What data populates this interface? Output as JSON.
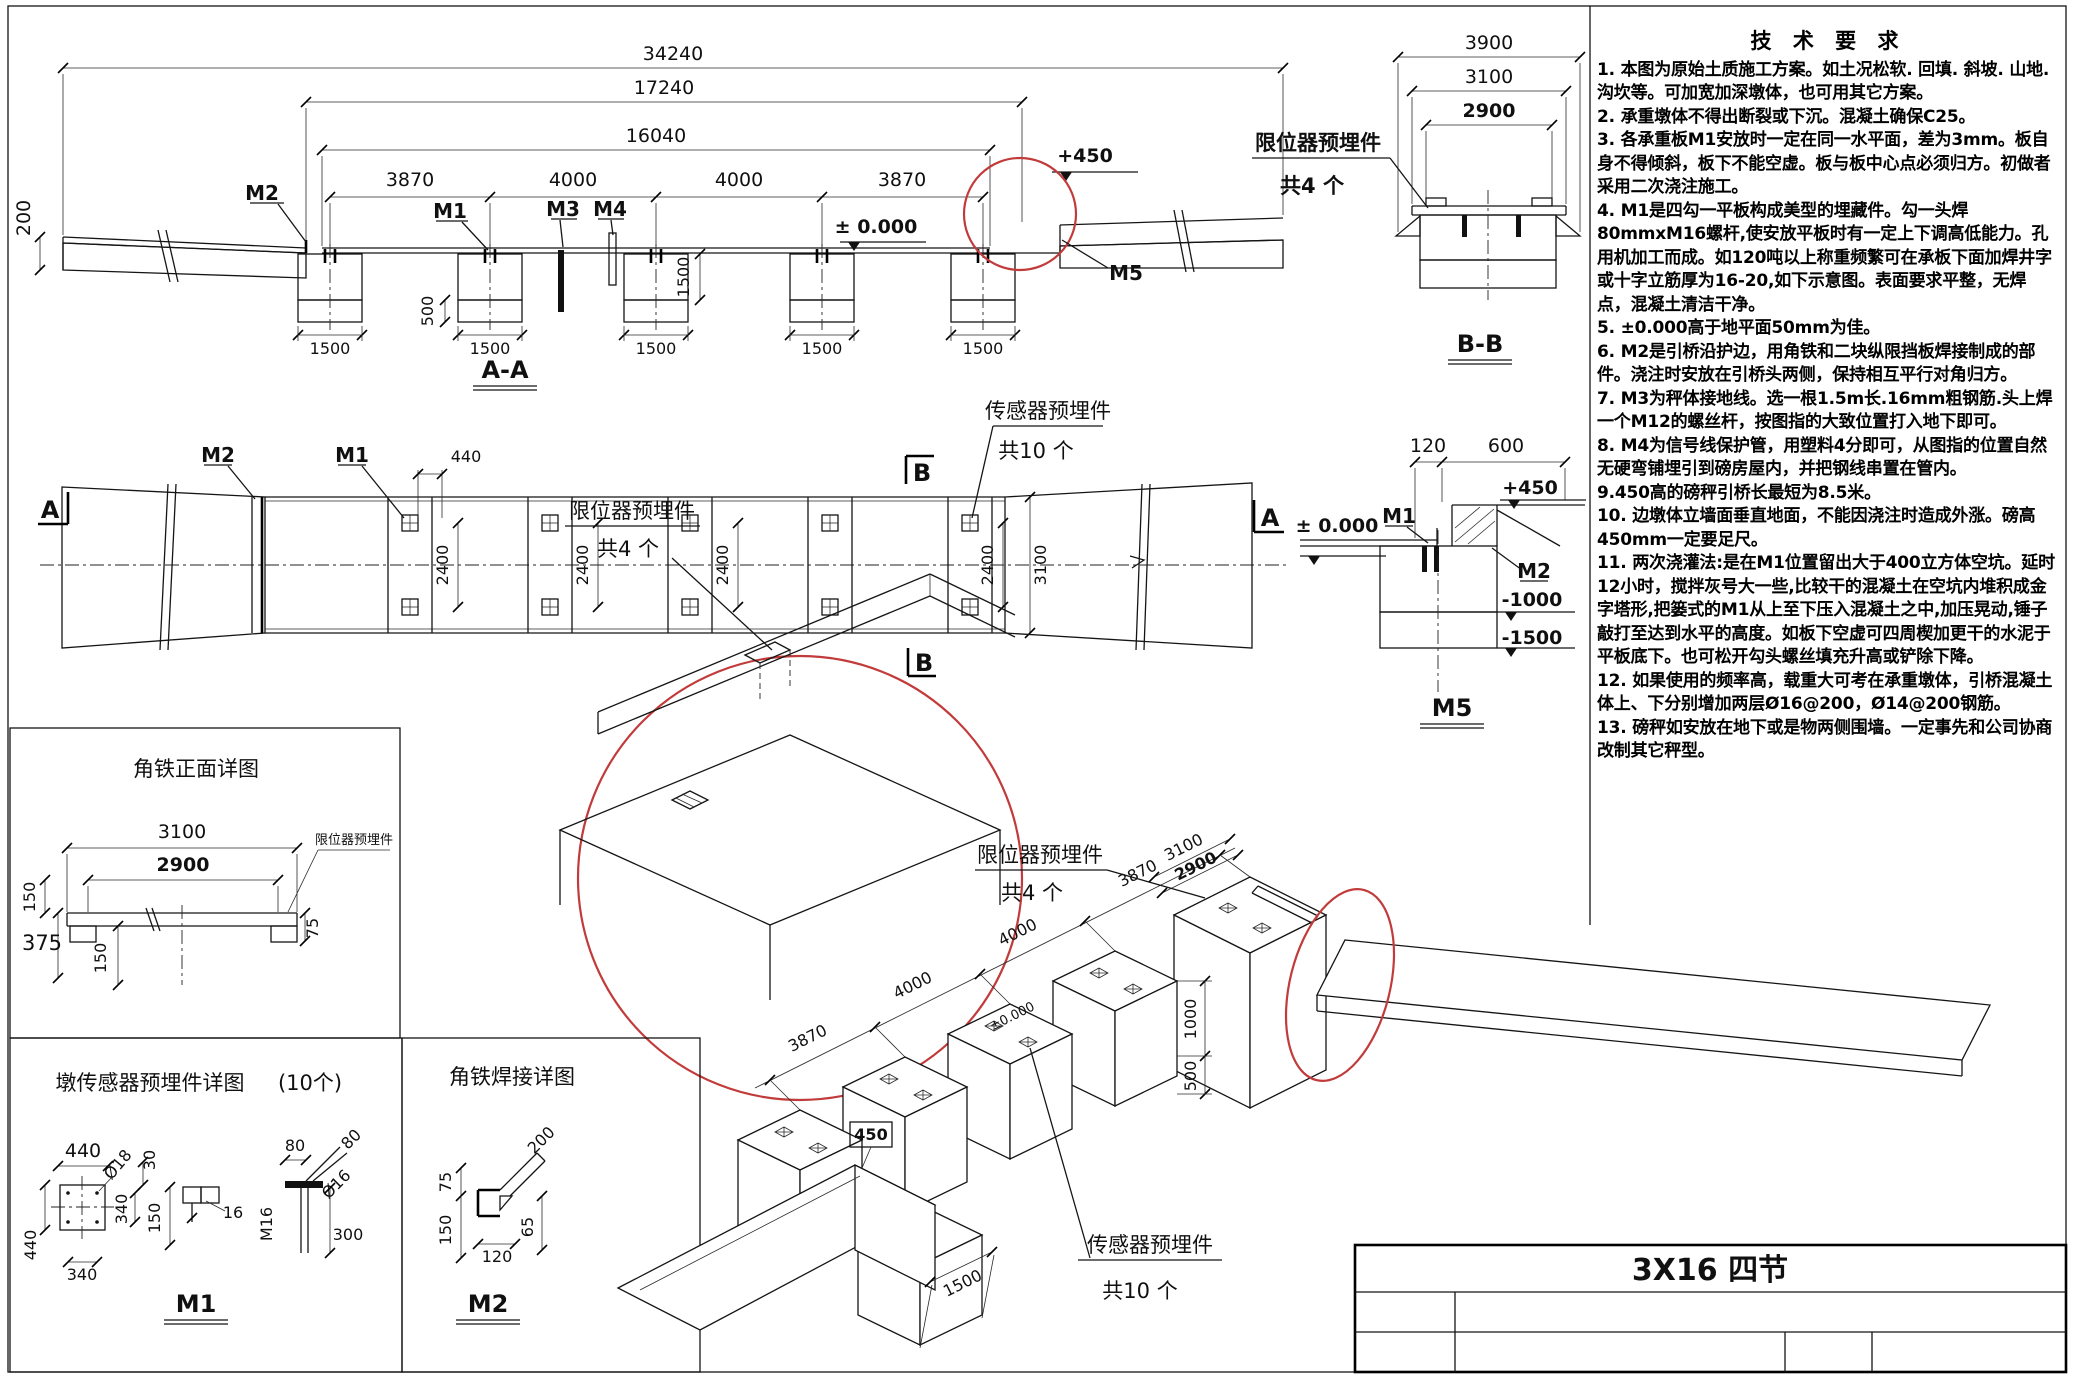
{
  "sheet": {
    "title_block": {
      "model": "3X16 四节"
    }
  },
  "tech_notes": {
    "title": "技 术 要 求",
    "items": [
      "1. 本图为原始土质施工方案。如土况松软. 回填. 斜坡. 山地. 沟坎等。可加宽加深墩体，也可用其它方案。",
      "2. 承重墩体不得出断裂或下沉。混凝土确保C25。",
      "3. 各承重板M1安放时一定在同一水平面，差为3mm。板自身不得倾斜，板下不能空虚。板与板中心点必须归方。初做者采用二次浇注施工。",
      "4. M1是四勾一平板构成美型的埋藏件。勾一头焊80mmxM16螺杆,使安放平板时有一定上下调高低能力。孔用机加工而成。如120吨以上称重频繁可在承板下面加焊井字或十字立筋厚为16-20,如下示意图。表面要求平整，无焊点，混凝土清洁干净。",
      "5. ±0.000高于地平面50mm为佳。",
      "6. M2是引桥沿护边，用角铁和二块纵限挡板焊接制成的部件。浇注时安放在引桥头两侧，保持相互平行对角归方。",
      "7. M3为秤体接地线。选一根1.5m长.16mm粗钢筋.头上焊一个M12的螺丝杆，按图指的大致位置打入地下即可。",
      "8. M4为信号线保护管，用塑料4分即可，从图指的位置自然无硬弯铺埋引到磅房屋内，并把钢线串置在管内。",
      "9.450高的磅秤引桥长最短为8.5米。",
      "10. 边墩体立墙面垂直地面，不能因浇注时造成外涨。磅高450mm一定要足尺。",
      "11. 两次浇灌法:是在M1位置留出大于400立方体空坑。延时12小时，搅拌灰号大一些,比较干的混凝土在空坑内堆积成金字塔形,把篓式的M1从上至下压入混凝土之中,加压晃动,锤子敲打至达到水平的高度。如板下空虚可四周楔加更干的水泥于平板底下。也可松开勾头螺丝填充升高或铲除下降。",
      "12. 如果使用的频率高，载重大可考在承重墩体，引桥混凝土体上、下分别增加两层Ø16@200，Ø14@200钢筋。",
      "13. 磅秤如安放在地下或是物两侧围墙。一定事先和公司协商改制其它秤型。"
    ]
  },
  "section_aa": {
    "title": "A-A",
    "dim_34240": "34240",
    "dim_17240": "17240",
    "dim_16040": "16040",
    "dim_3870": "3870",
    "dim_4000": "4000",
    "dim_200": "200",
    "dim_500": "500",
    "dim_1500": "1500",
    "level_zero": "± 0.000",
    "level_450": "+450",
    "label_m1": "M1",
    "label_m2": "M2",
    "label_m3": "M3",
    "label_m4": "M4",
    "label_m5": "M5"
  },
  "section_bb": {
    "title": "B-B",
    "dim_3900": "3900",
    "dim_3100": "3100",
    "dim_2900": "2900",
    "callout_limiter_line1": "限位器预埋件",
    "callout_limiter_line2": "共4 个"
  },
  "plan": {
    "marker_a": "A",
    "marker_b": "B",
    "label_m1": "M1",
    "label_m2": "M2",
    "dim_440": "440",
    "dim_2400": "2400",
    "dim_3100": "3100",
    "callout_sensor_line1": "传感器预埋件",
    "callout_sensor_line2": "共10 个"
  },
  "detail_m5": {
    "title": "M5",
    "dim_120": "120",
    "dim_600": "600",
    "level_450": "+450",
    "level_zero": "± 0.000",
    "level_m1000": "-1000",
    "level_m1500": "-1500",
    "label_m1": "M1",
    "label_m2": "M2"
  },
  "detail_corner": {
    "callout_line1": "限位器预埋件",
    "callout_line2": "共4 个"
  },
  "detail_angle_front": {
    "title": "角铁正面详图",
    "dim_3100": "3100",
    "dim_2900": "2900",
    "dim_150": "150",
    "dim_375": "375",
    "dim_75": "75",
    "callout_limiter": "限位器预埋件"
  },
  "detail_m1": {
    "title": "墩传感器预埋件详图",
    "title_count": "(10个)",
    "name": "M1",
    "dim_440": "440",
    "dim_340": "340",
    "dim_d18": "Ø18",
    "dim_30": "30",
    "dim_150": "150",
    "dim_16": "16",
    "dim_80": "80",
    "dim_d16": "Ø16",
    "dim_m16": "M16",
    "dim_300": "300"
  },
  "detail_m2": {
    "title": "角铁焊接详图",
    "name": "M2",
    "dim_75": "75",
    "dim_150": "150",
    "dim_120": "120",
    "dim_65": "65",
    "dim_200": "200"
  },
  "iso": {
    "dim_3870": "3870",
    "dim_4000": "4000",
    "dim_3100": "3100",
    "dim_2900": "2900",
    "dim_1000": "1000",
    "dim_500": "500",
    "dim_450": "450",
    "dim_1500": "1500",
    "level_zero": "±0.000",
    "callout_limiter_line1": "限位器预埋件",
    "callout_limiter_line2": "共4 个",
    "callout_sensor_line1": "传感器预埋件",
    "callout_sensor_line2": "共10 个"
  }
}
